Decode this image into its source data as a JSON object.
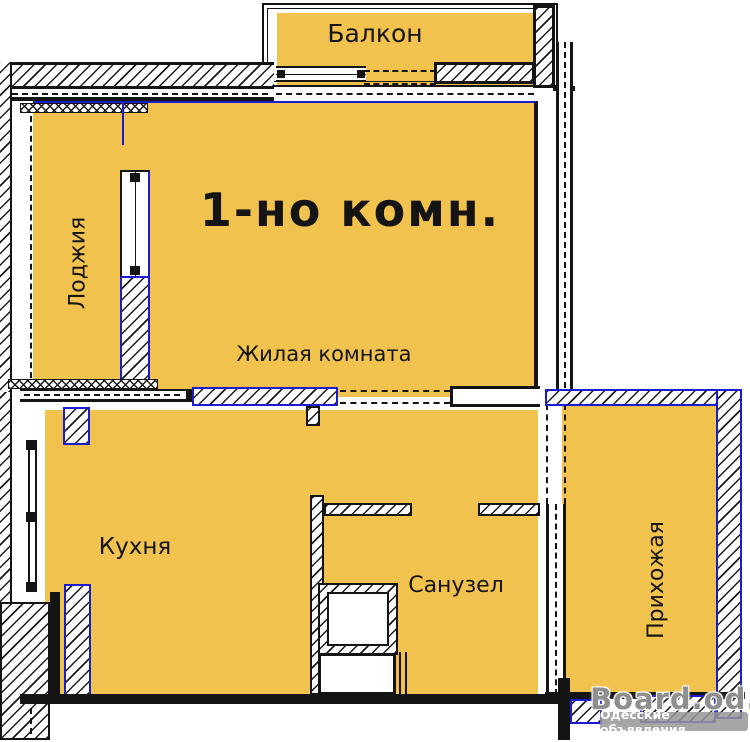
{
  "plan": {
    "title": "1-но комн.",
    "rooms": {
      "balcony": "Балкон",
      "loggia": "Лоджия",
      "living_room": "Жилая комната",
      "kitchen": "Кухня",
      "bathroom": "Санузел",
      "hallway": "Прихожая"
    },
    "colors": {
      "room_fill": "#F2C24E",
      "new_partition_blue": "#1B1BD0",
      "wall_ink": "#141414"
    }
  },
  "watermark": {
    "site": "Board.od.ua",
    "caption": "Одесские объявления"
  }
}
